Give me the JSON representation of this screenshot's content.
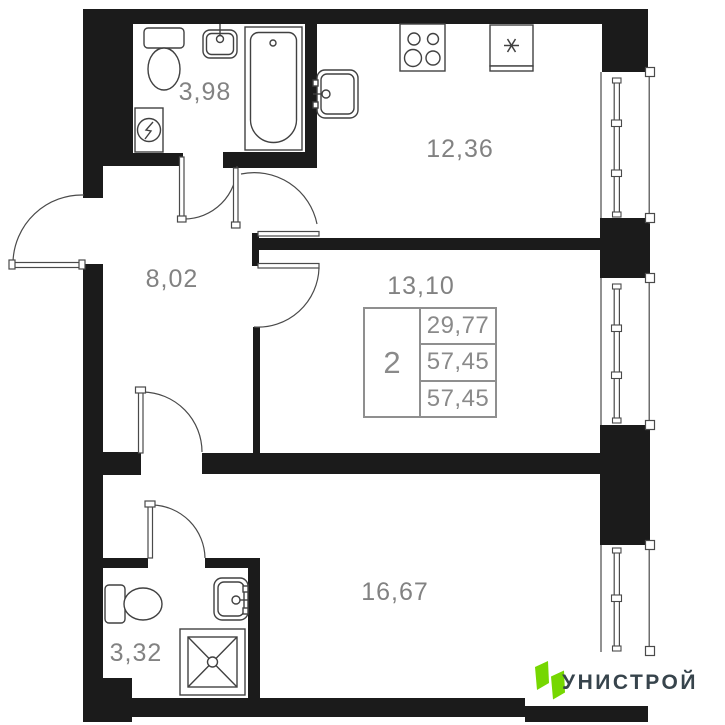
{
  "plan": {
    "room_labels": {
      "bathroom_top": "3,98",
      "kitchen": "12,36",
      "hallway": "8,02",
      "living": "13,10",
      "bedroom": "16,67",
      "bathroom_bottom": "3,32"
    },
    "info_table": {
      "rooms_count": "2",
      "row1": "29,77",
      "row2": "57,45",
      "row3": "57,45"
    },
    "logo": {
      "text": "УНИСТРОЙ"
    },
    "colors": {
      "wall": "#1b1b1b",
      "line": "#414141",
      "label_gray": "#828282",
      "table_gray": "#8f8f8f",
      "logo_green": "#76D701",
      "logo_text": "#37444C"
    },
    "icons": [
      "toilet-icon",
      "sink-icon",
      "bathtub-icon",
      "electric-panel-icon",
      "stove-icon",
      "fridge-snowflake-icon",
      "shower-icon",
      "door-arc-icon",
      "window-icon"
    ]
  }
}
